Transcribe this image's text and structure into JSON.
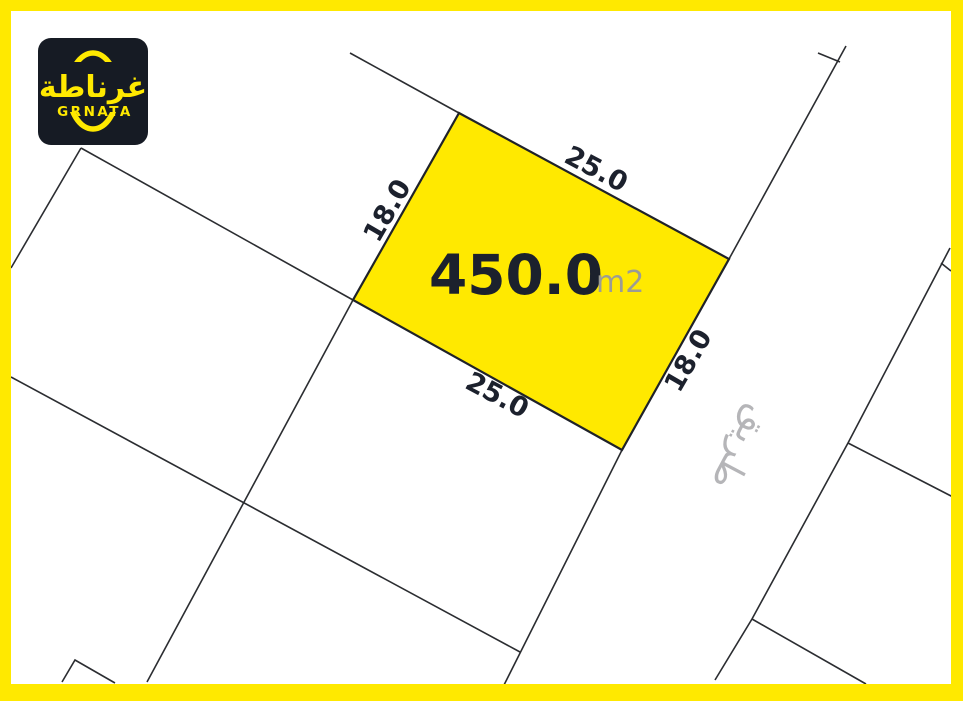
{
  "brand": {
    "logo_arabic": "غرناطة",
    "logo_latin": "GRNATA"
  },
  "plot": {
    "area_value": "450.0",
    "area_unit": "m2",
    "dimensions": {
      "top": "25.0",
      "bottom": "25.0",
      "left": "18.0",
      "right": "18.0"
    }
  },
  "road": {
    "label_arabic": "طريق"
  },
  "colors": {
    "accent_yellow": "#FFE900",
    "plot_fill": "#FFE900",
    "line": "#2B2D31",
    "text_dark": "#1C212D",
    "text_gray": "#9C9C94",
    "road_gray": "#B5B5B8",
    "logo_bg": "#161B24"
  }
}
